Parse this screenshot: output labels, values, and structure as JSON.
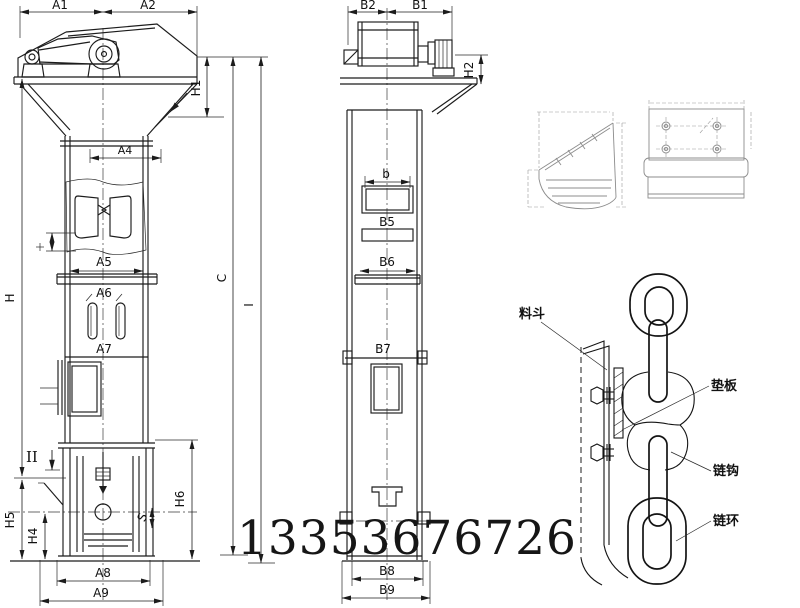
{
  "drawing": {
    "front": {
      "a1": "A1",
      "a2": "A2",
      "a4": "A4",
      "a5": "A5",
      "a6": "A6",
      "a7": "A7",
      "a8": "A8",
      "a9": "A9",
      "h": "H",
      "h1": "H1",
      "h4": "H4",
      "h5": "H5",
      "h6": "H6",
      "s": "S",
      "section_mark": "II"
    },
    "side": {
      "b2": "B2",
      "b1": "B1",
      "b_small": "b",
      "b5": "B5",
      "b6": "B6",
      "b7": "B7",
      "b8": "B8",
      "b9": "B9",
      "h2": "H2",
      "c": "C",
      "i": "I"
    },
    "chain_detail": {
      "bucket": "料斗",
      "pad_plate": "垫板",
      "chain_hook": "链钩",
      "chain_ring": "链环"
    },
    "watermark": {
      "phone": "13353676726"
    }
  }
}
